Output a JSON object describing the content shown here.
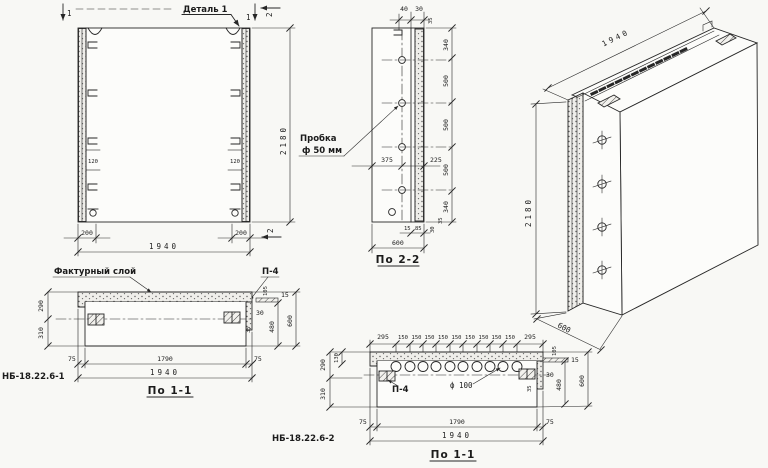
{
  "front": {
    "detail": "Деталь 1",
    "cut1": "1",
    "cut2": "2",
    "h": "2180",
    "w": "1940",
    "off_l": "200",
    "off_r": "200",
    "rib_l": "120",
    "rib_r": "120"
  },
  "s22": {
    "title": "По 2-2",
    "plug1": "Пробка",
    "plug2": "ф 50 мм",
    "t40": "40",
    "t30": "30",
    "t35": "35",
    "chain": [
      "340",
      "500",
      "500",
      "500",
      "340"
    ],
    "d375": "375",
    "d225": "225",
    "w": "600",
    "b15": "15",
    "b85": "85",
    "b30": "30",
    "b35": "35"
  },
  "iso": {
    "w": "1940",
    "h": "2180",
    "d": "600"
  },
  "s11a": {
    "code": "НБ-18.22.6-1",
    "title": "По 1-1",
    "layer": "Фактурный слой",
    "p4": "П-4",
    "d290": "290",
    "d310": "310",
    "d105": "105",
    "d15": "15",
    "d30": "30",
    "d35": "35",
    "d480": "480",
    "d600": "600",
    "d75l": "75",
    "d1790": "1790",
    "d75r": "75",
    "d1940": "1940"
  },
  "s11b": {
    "code": "НБ-18.22.6-2",
    "title": "По 1-1",
    "p4": "П-4",
    "hole": "ф 100",
    "chain": [
      "295",
      "150",
      "150",
      "150",
      "150",
      "150",
      "150",
      "150",
      "150",
      "150",
      "295"
    ],
    "d290": "290",
    "d130": "130",
    "d310": "310",
    "d105": "105",
    "d15": "15",
    "d30": "30",
    "d35": "35",
    "d480": "480",
    "d600": "600",
    "d75l": "75",
    "d1790": "1790",
    "d75r": "75",
    "d1940": "1940"
  }
}
